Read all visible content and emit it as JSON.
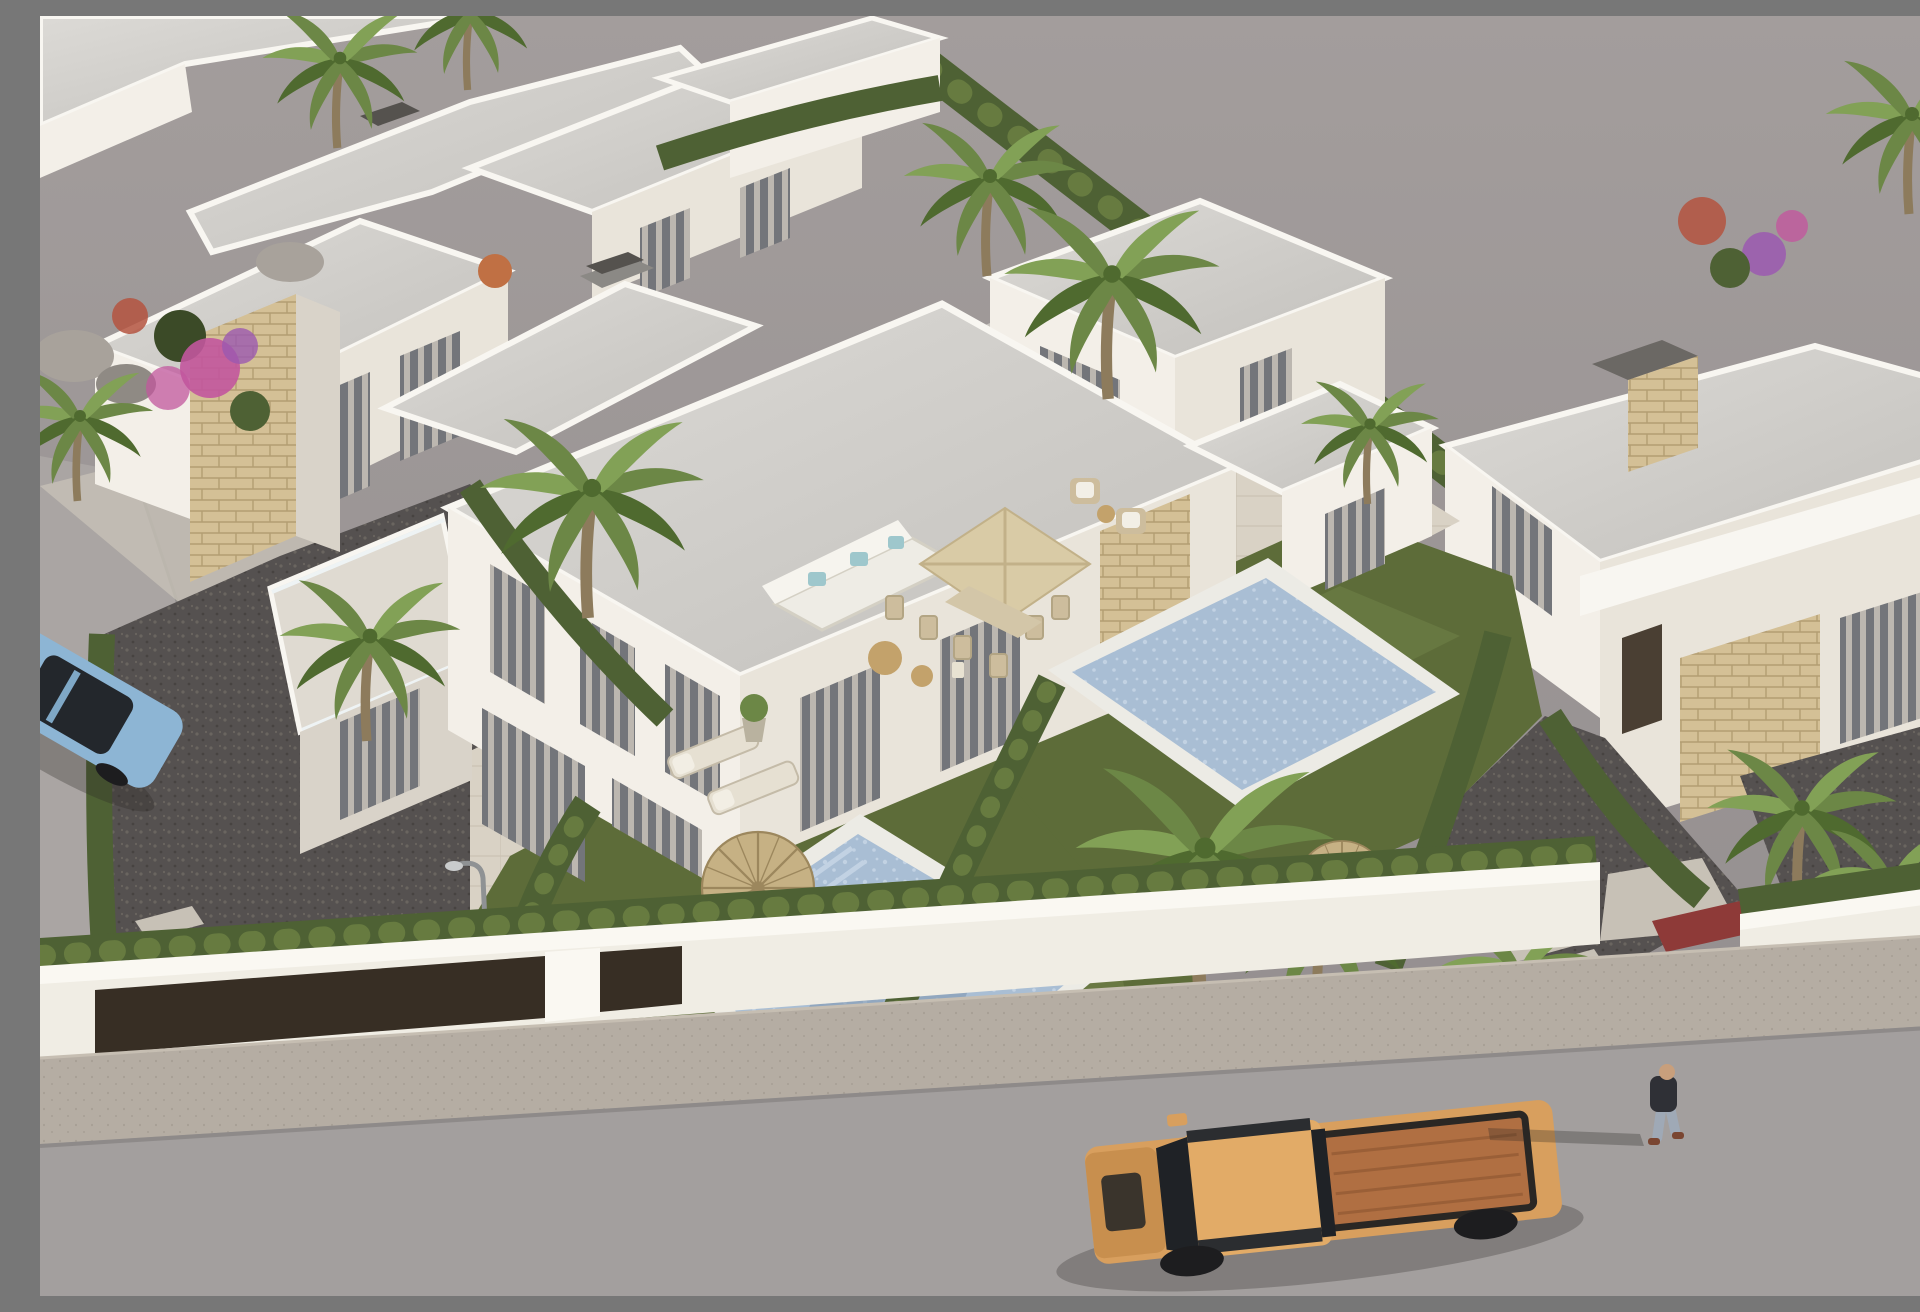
{
  "meta": {
    "title": "Aerial 3D render of a modern white villa development",
    "width_px": 1920,
    "height_px": 1280
  },
  "scene": {
    "description": "High aerial three-quarter render of a residential development of modern flat-roofed white villas with stone-clad accents. The central semi-detached villa has a tiled terrace with a square parasol, outdoor dining set and corner sofa, two private pools set in lawns, cypress hedges dividing plots, dark gravel yards with stepping stones, palm trees and bougainvillea. A white perimeter wall with dark gates runs along a sidewalk and asphalt street in the foreground where an orange pickup truck drives, a man walks on the pavement, a blue car is parked on the left side road and the plain grey unmodelled ground plane fills the upper right.",
    "lighting": "Late-afternoon sun with long soft shadows cast toward the lower left",
    "camera": "High oblique aerial view, buildings receding diagonally to the upper left",
    "objects": [
      "plain-grey-ground-plane",
      "asphalt-street",
      "sidewalk",
      "perimeter-wall",
      "dark-driveway-gates",
      "gravel-gardens",
      "stepping-stones",
      "lawns",
      "left-pool",
      "right-pool",
      "main-duplex-villa",
      "roof-terrace-with-glass-rail",
      "stone-cladding-panels",
      "background-villas",
      "right-villa",
      "cypress-hedges",
      "palm-trees",
      "banana-plants",
      "bougainvillea",
      "square-beige-parasol",
      "outdoor-dining-set",
      "white-corner-sofa",
      "rattan-armchairs",
      "sun-loungers",
      "straw-umbrellas",
      "wooden-deck-chairs",
      "potted-plant",
      "street-lamp",
      "orange-pickup-truck",
      "parked-blue-car",
      "cars-behind-hedge",
      "walking-man",
      "partial-pedestrian-right-edge",
      "rock-cluster"
    ]
  },
  "colors": {
    "bgTop": "#a39d9c",
    "bgBottom": "#918c8d",
    "road": "#a39f9e",
    "roadLight": "#aaa5a3",
    "curb": "#8e8a89",
    "sidewalk": "#b5ada3",
    "sidewalkDot": "#a79f94",
    "wallSun": "#f0ede4",
    "wallTop": "#faf8f2",
    "wallShade": "#d7d2c9",
    "gate": "#372e24",
    "gravel": "#555150",
    "gravelLight": "#6a6560",
    "gravelDark": "#474341",
    "pathConc": "#c7c1b6",
    "pathShade": "#aeA79c",
    "lawn": "#5d6c39",
    "lawnLight": "#72834a",
    "lawnDark": "#46522c",
    "hedge": "#4e6134",
    "hedgeLight": "#677b40",
    "hedgeDark": "#3b4a27",
    "roofA": "#dcdad6",
    "roofB": "#c2c0bc",
    "parapet": "#f8f6f1",
    "faceSun": "#f3efe8",
    "faceMid": "#e9e4da",
    "faceShade": "#d9d3c9",
    "stone": "#d4c096",
    "stoneLine": "#b39d72",
    "glass": "#73757a",
    "curtain": "#c9c3ba",
    "windowDark": "#42444a",
    "tile": "#d9d2c5",
    "tileLine": "#c7bfb0",
    "pool": "#a9bed4",
    "poolLight": "#c2d2e3",
    "poolShadow": "#7d93ad",
    "poolRim": "#ecebe5",
    "parasol": "#d9cba6",
    "parasolShade": "#c2b189",
    "straw": "#c6b184",
    "strawLine": "#9c875d",
    "sofa": "#eeece5",
    "teal": "#9ec7cc",
    "wood": "#c3a26b",
    "rattan": "#cdbd9d",
    "trunk": "#8d7b5c",
    "palmA": "#4f6a2f",
    "palmB": "#6c8746",
    "palmC": "#82a156",
    "banana": "#5a7a36",
    "flowerPink": "#c2579d",
    "flowerPurple": "#9b59b0",
    "flowerRed": "#b4543f",
    "rock": "#a8a29b",
    "rockShade": "#8f8a84",
    "truck": "#d89f5e",
    "truckHood": "#c88f4e",
    "truckBed": "#b06f42",
    "truckGlass": "#1f2226",
    "tire": "#1d1d1f",
    "carBlue": "#8db5d4",
    "carBlueDark": "#23272c",
    "carRed": "#8e3a38",
    "carDark": "#3a4356",
    "skin": "#c89f7c",
    "shirt": "#2f3036",
    "jeans": "#9fa9b6",
    "pink": "#d4a4a0",
    "lampPole": "#8f9294",
    "shadow": "#2b2825"
  }
}
